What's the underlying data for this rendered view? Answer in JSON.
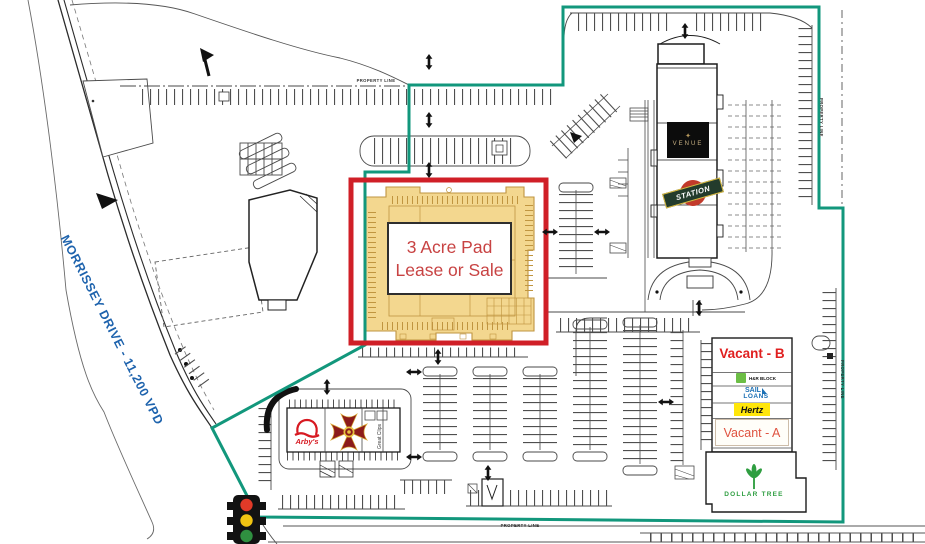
{
  "plan": {
    "road_label": "MORRISSEY DRIVE - 11,200 VPD",
    "property_line_label": "PROPERTY LINE",
    "pad": {
      "line1": "3 Acre Pad",
      "line2": "Lease or Sale"
    },
    "anchor": {
      "venue": "VENUE",
      "station": "STATION"
    },
    "strip": {
      "vacant_b": "Vacant - B",
      "hr_block": "H&R BLOCK",
      "sail_line1": "SAIL",
      "sail_line2": "LOANS",
      "hertz": "Hertz",
      "vacant_a": "Vacant - A",
      "dollar_tree": "DOLLAR TREE"
    },
    "outparcel": {
      "arbys": "Arby's",
      "great_clips": "Great Clips"
    },
    "colors": {
      "property_line": "#12977c",
      "pad_border": "#d01f27",
      "pad_fill": "#f3d78f",
      "pad_text": "#c84343",
      "road_label": "#1e63ad",
      "vacant_b_text": "#e01f1f",
      "vacant_a_text": "#df5340",
      "hertz_bg": "#ffe60a",
      "hr_block_green": "#6cbe45",
      "sail_blue": "#1a6fb5",
      "dollar_tree_green": "#2f9e41",
      "arbys_red": "#d71921",
      "station_red": "#c23a2b",
      "station_band": "#233c2c",
      "venue_gold": "#c9b183"
    }
  }
}
